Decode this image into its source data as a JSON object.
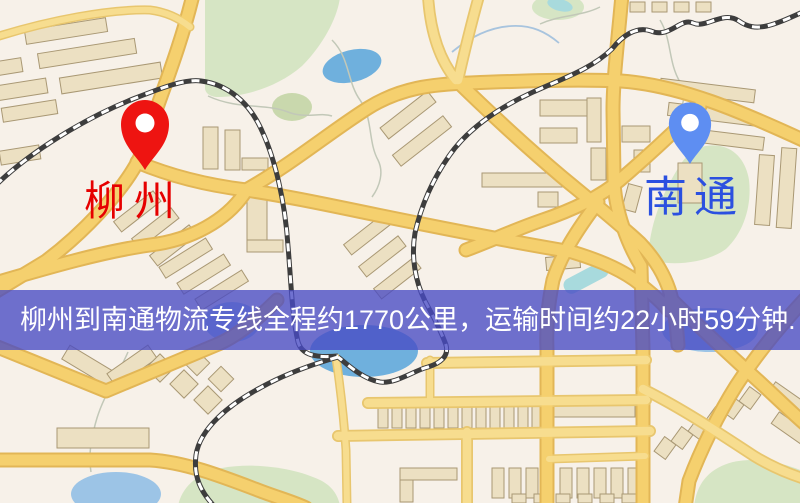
{
  "map": {
    "markers": [
      {
        "id": "origin",
        "label": "柳州",
        "pin_color": "#ee1411",
        "label_color": "#e60000"
      },
      {
        "id": "destination",
        "label": "南通",
        "pin_color": "#5e8ef2",
        "label_color": "#2b50e0"
      }
    ],
    "banner": {
      "text": "柳州到南通物流专线全程约1770公里，运输时间约22小时59分钟."
    },
    "legend_icons": [
      "red-location-pin-icon",
      "blue-location-pin-icon"
    ]
  },
  "palette": {
    "bg": "#f7f1e9",
    "park": "#d6e5c4",
    "park_dark": "#c9d8ad",
    "water": "#6fb0dd",
    "water_light": "#9cc4e6",
    "water_teal": "#a8dadd",
    "road_fill": "#f5d06e",
    "road_case": "#e2b656",
    "road2_fill": "#f7dd8f",
    "road2_case": "#e8c66e",
    "bld_fill": "#ece0c2",
    "bld_stroke": "#a99874",
    "rail_dark": "#3d3d3d",
    "stream": "#c2c8b8",
    "stream_blue": "#a8c4de",
    "pin_red": "#ee1411",
    "pin_blue": "#5e8ef2",
    "label_red": "#e60000",
    "label_blue": "#2b50e0",
    "banner_bg": "rgba(72,74,196,0.78)",
    "banner_text": "#ffffff"
  }
}
